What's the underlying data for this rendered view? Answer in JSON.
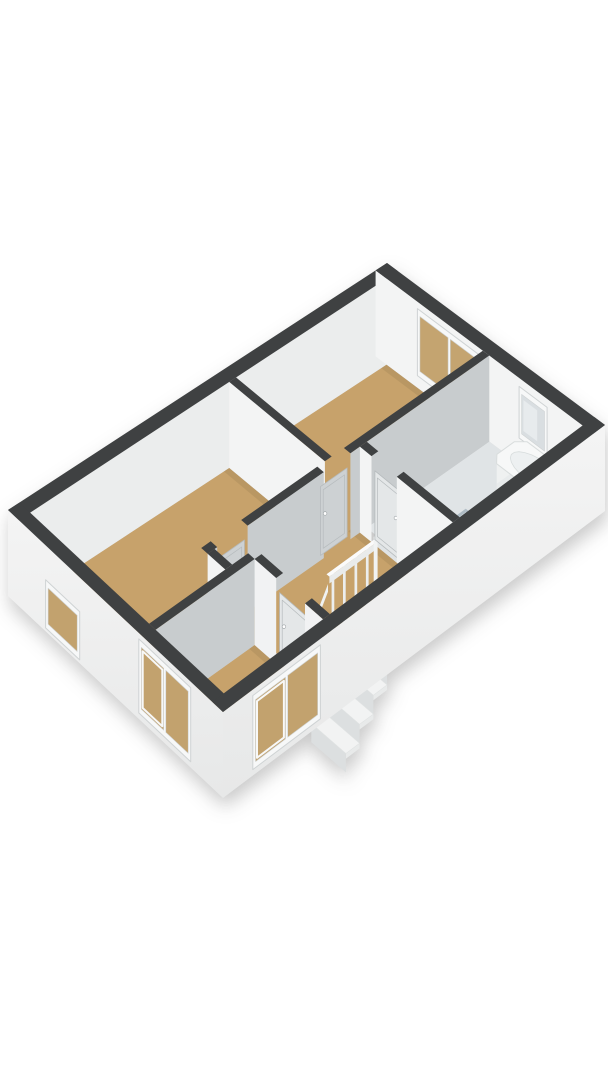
{
  "meta": {
    "app": "3d-floorplan-render",
    "floor_label": ""
  },
  "scene": {
    "canvas": {
      "width": 608,
      "height": 1080
    },
    "projection": {
      "corners": {
        "W": [
          8,
          510
        ],
        "N": [
          387,
          263
        ],
        "E": [
          605,
          425
        ],
        "S": [
          223,
          712
        ]
      },
      "plan_size": [
        10,
        6
      ],
      "wall_height_px": 86
    },
    "palette": {
      "background": "#ffffff",
      "cap": "#3f4142",
      "ext_face_top": "#f4f4f4",
      "ext_face_bottom": "#e7e8e8",
      "int_face_white": "#f3f4f4",
      "int_face_gray": "#c8ccce",
      "nw_inner": "#ebeded",
      "floor_tan": "#c7a26b",
      "floor_bath": "#e0e4e6",
      "glass_tan": "#c4a470",
      "glass_frosted": "#d9dee1",
      "frame_white": "#f7f8f8",
      "frame_edge": "#cfd3d4",
      "door_gray": "#cdd1d3",
      "door_light": "#e4e7e8",
      "door_edge": "#b6bbbd",
      "fixture_white": "#f7f8f8",
      "fixture_edge": "#d9dddd",
      "hole_top": "#bf9f66",
      "hole_bottom": "#79643f"
    },
    "items": [
      {
        "kind": "floor",
        "name": "floor-bedroom-left",
        "fill": "#c7a26b",
        "shade_ne": true,
        "points": [
          [
            0.3,
            0.3
          ],
          [
            5.55,
            0.3
          ],
          [
            5.55,
            2.95
          ],
          [
            2.3,
            2.95
          ],
          [
            2.3,
            3.62
          ],
          [
            0.3,
            3.62
          ]
        ]
      },
      {
        "kind": "floor",
        "name": "floor-bedroom-top",
        "fill": "#c7a26b",
        "shade_ne": true,
        "points": [
          [
            5.73,
            0.3
          ],
          [
            9.7,
            0.3
          ],
          [
            9.7,
            2.95
          ],
          [
            5.73,
            2.95
          ]
        ]
      },
      {
        "kind": "floor",
        "name": "floor-landing",
        "fill": "#c7a26b",
        "shade_ne": true,
        "points": [
          [
            2.48,
            2.95
          ],
          [
            6.3,
            2.95
          ],
          [
            6.3,
            5.7
          ],
          [
            3.08,
            5.7
          ],
          [
            3.08,
            3.8
          ],
          [
            2.48,
            3.8
          ]
        ]
      },
      {
        "kind": "floor",
        "name": "floor-bedroom-bottom",
        "fill": "#c7a26b",
        "shade_ne": true,
        "points": [
          [
            0.3,
            3.8
          ],
          [
            2.9,
            3.8
          ],
          [
            2.9,
            5.7
          ],
          [
            0.3,
            5.7
          ]
        ]
      },
      {
        "kind": "floor",
        "name": "floor-threshold-bottom-door",
        "fill": "#c7a26b",
        "points": [
          [
            2.9,
            4.4
          ],
          [
            3.08,
            4.4
          ],
          [
            3.08,
            5.2
          ],
          [
            2.9,
            5.2
          ]
        ]
      },
      {
        "kind": "floor",
        "name": "floor-threshold-bath-door",
        "fill": "#e0e4e6",
        "points": [
          [
            6.3,
            3.45
          ],
          [
            6.48,
            3.45
          ],
          [
            6.48,
            4.15
          ],
          [
            6.3,
            4.15
          ]
        ]
      },
      {
        "kind": "floor",
        "name": "floor-bathroom",
        "fill": "#e0e4e6",
        "points": [
          [
            6.48,
            3.13
          ],
          [
            9.7,
            3.13
          ],
          [
            9.7,
            5.7
          ],
          [
            6.48,
            5.7
          ]
        ]
      },
      {
        "kind": "stairs",
        "name": "staircase-well",
        "hole": [
          3.5,
          4.6,
          5.3,
          5.7
        ],
        "treads": {
          "n": 5,
          "a_top": 5.3,
          "depth": 0.36,
          "b1": 4.74,
          "b2": 5.7,
          "h_top": 0.12,
          "drop": 0.22
        }
      },
      {
        "kind": "railing",
        "name": "stair-railing",
        "a1": 4.05,
        "a2": 5.3,
        "b": 4.62,
        "w": 0.07,
        "h_top": 0.74,
        "posts": [
          4.18,
          4.48,
          4.78,
          5.08
        ],
        "slope": {
          "a1": 4.05,
          "a2": 3.5,
          "h1": 0.64,
          "h2": 0.18
        }
      },
      {
        "kind": "wall",
        "name": "wall-exterior-nw",
        "rect": [
          0,
          0,
          10,
          0.3
        ],
        "face_se": "#ebeded"
      },
      {
        "kind": "wall",
        "name": "wall-exterior-ne",
        "rect": [
          9.7,
          0,
          10,
          6
        ],
        "face_sw": "#f3f4f4"
      },
      {
        "kind": "window",
        "name": "window-bedroom-top-double",
        "plane": "a",
        "at": 9.7,
        "c1": 1.15,
        "c2": 2.9,
        "v0": 0.14,
        "v1": 0.92,
        "mullions": [
          0.5
        ],
        "glass": "#c4a470"
      },
      {
        "kind": "window",
        "name": "window-bathroom-frosted",
        "plane": "a",
        "at": 9.7,
        "c1": 3.95,
        "c2": 4.72,
        "v0": 0.3,
        "v1": 0.9,
        "mullions": [],
        "glass": "#d9dee1",
        "frosted": true
      },
      {
        "kind": "wall",
        "name": "wall-bedrooms-left-top-divider",
        "rect": [
          5.55,
          0.3,
          5.73,
          2.95
        ],
        "face_sw": "#f3f4f4"
      },
      {
        "kind": "wall",
        "name": "wall-landing-nw-seg1",
        "rect": [
          2.3,
          2.95,
          2.55,
          3.13
        ],
        "face_se": "#c8ccce"
      },
      {
        "kind": "door",
        "name": "door-bedroom-left",
        "plane": "b",
        "at": 3.04,
        "c1": 2.55,
        "c2": 3.35,
        "fill": "#cdd1d3",
        "handle_at_c2": false
      },
      {
        "kind": "wall",
        "name": "wall-landing-nw-seg2",
        "rect": [
          3.35,
          2.95,
          5.35,
          3.13
        ],
        "face_se": "#c8ccce"
      },
      {
        "kind": "door",
        "name": "door-bedroom-top",
        "plane": "b",
        "at": 3.04,
        "c1": 5.35,
        "c2": 6.05,
        "fill": "#cdd1d3",
        "handle_at_c2": false
      },
      {
        "kind": "wall",
        "name": "wall-landing-nw-seg3",
        "rect": [
          6.05,
          2.95,
          9.7,
          3.13
        ],
        "face_se": "#c8ccce"
      },
      {
        "kind": "wall",
        "name": "wall-jog",
        "rect": [
          2.3,
          3.13,
          2.48,
          3.62
        ],
        "face_sw": "#f3f4f4",
        "face_se": "#c8ccce"
      },
      {
        "kind": "tub",
        "name": "bathtub",
        "rect": [
          8.88,
          4.02,
          9.68,
          5.66
        ],
        "h": 0.34,
        "chamfer": 0.17,
        "inner": {
          "cx": 9.28,
          "cy": 4.84,
          "rx": 0.27,
          "ry": 0.63
        },
        "faucet": [
          9.28,
          5.42
        ]
      },
      {
        "kind": "sink",
        "name": "bathroom-sink",
        "rect": [
          6.52,
          4.18,
          7.14,
          5.02
        ],
        "h": 0.46,
        "faucet": [
          6.83,
          4.26
        ]
      },
      {
        "kind": "shower",
        "name": "shower",
        "rect": [
          6.52,
          4.98,
          7.32,
          5.66
        ],
        "glass_h": 0.58
      },
      {
        "kind": "wall",
        "name": "wall-bathroom-sw-seg1",
        "rect": [
          6.3,
          3.13,
          6.48,
          3.45
        ],
        "face_sw": "#f3f4f4"
      },
      {
        "kind": "door",
        "name": "door-bathroom",
        "plane": "a",
        "at": 6.39,
        "c1": 3.45,
        "c2": 4.15,
        "fill": "#e4e7e8",
        "handle_at_c2": true
      },
      {
        "kind": "wall",
        "name": "wall-bathroom-sw-seg2",
        "rect": [
          6.3,
          4.15,
          6.48,
          5.7
        ],
        "face_sw": "#f3f4f4"
      },
      {
        "kind": "wall",
        "name": "wall-bedroom-bottom-nw",
        "rect": [
          0.3,
          3.62,
          2.9,
          3.8
        ],
        "face_se": "#c8ccce"
      },
      {
        "kind": "wall",
        "name": "wall-bedroom-bottom-ne-seg1",
        "rect": [
          2.9,
          3.8,
          3.08,
          4.4
        ],
        "face_sw": "#f1f2f3"
      },
      {
        "kind": "door",
        "name": "door-bedroom-bottom",
        "plane": "a",
        "at": 2.99,
        "c1": 4.4,
        "c2": 5.2,
        "fill": "#e4e7e8",
        "handle_at_c2": false
      },
      {
        "kind": "wall",
        "name": "wall-bedroom-bottom-ne-seg2",
        "rect": [
          2.9,
          5.2,
          3.08,
          5.7
        ],
        "face_sw": "#f1f2f3"
      },
      {
        "kind": "wall",
        "name": "wall-exterior-sw",
        "rect": [
          0,
          0,
          0.3,
          6
        ],
        "face_sw": "EXT"
      },
      {
        "kind": "window",
        "name": "window-sw-small",
        "plane": "a",
        "at": 0,
        "c1": 1.05,
        "c2": 2.0,
        "v0": 0.04,
        "v1": 0.6,
        "mullions": [],
        "glass": "#c2a26e"
      },
      {
        "kind": "window",
        "name": "window-sw-sliding",
        "plane": "a",
        "at": 0,
        "c1": 3.65,
        "c2": 5.1,
        "v0": 0.07,
        "v1": 0.93,
        "mullions": [
          0.5
        ],
        "glass": "#c2a26e",
        "sliding": true
      },
      {
        "kind": "wall",
        "name": "wall-exterior-se",
        "rect": [
          0,
          5.7,
          10,
          6
        ],
        "face_se": "EXT"
      },
      {
        "kind": "window",
        "name": "window-se-bedroom-bottom",
        "plane": "b",
        "at": 6,
        "c1": 0.78,
        "c2": 2.55,
        "v0": 0.07,
        "v1": 0.93,
        "mullions": [
          0.5
        ],
        "glass": "#c2a26e",
        "sliding": true
      }
    ]
  }
}
